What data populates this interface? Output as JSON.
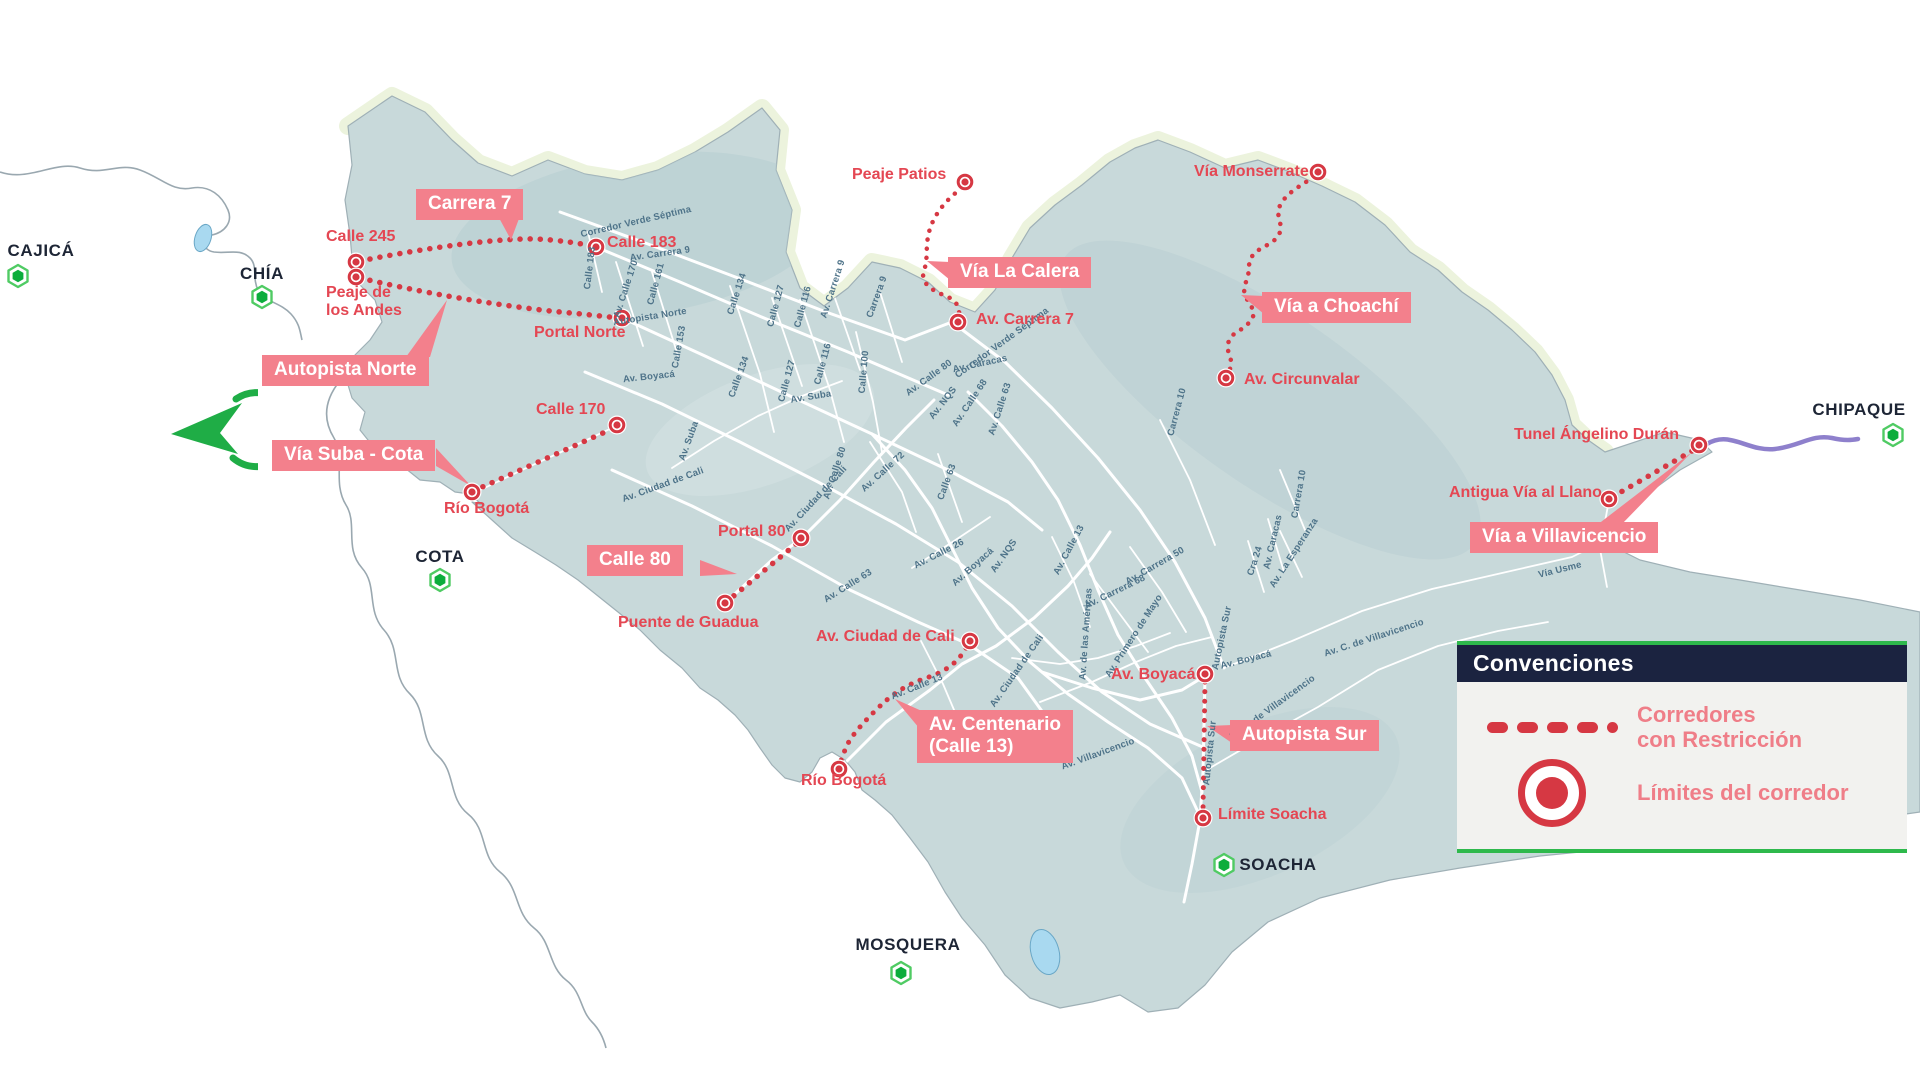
{
  "legend": {
    "title": "Convenciones",
    "items": [
      {
        "icon": "dotted-line-icon",
        "label": "Corredores\ncon Restricción"
      },
      {
        "icon": "red-circle-marker-icon",
        "label": "Límites del corredor"
      }
    ]
  },
  "icons": {
    "municipality_marker": "green-hexagon-icon",
    "corridor_limit_marker": "red-circle-marker-icon",
    "logo": "green-arrow-compass-icon"
  },
  "colors": {
    "map_fill": "#c8d9da",
    "map_hills": "#b7cdd1",
    "mountain_fringe": "#ecf3dd",
    "road": "#ffffff",
    "road_label": "#4e7389",
    "corridor_red": "#d63843",
    "label_red": "#e44753",
    "badge_pink": "#f3808c",
    "navy": "#1b2340",
    "legend_green": "#2eb94c",
    "hexagon_green": "#0cad3c",
    "purple": "#8e80cc",
    "lake_blue": "#a9d9f0",
    "city_text": "#1d2535"
  },
  "badges": [
    {
      "id": "carrera-7",
      "text": "Carrera 7",
      "x": 416,
      "y": 189
    },
    {
      "id": "autopista-norte",
      "text": "Autopista Norte",
      "x": 262,
      "y": 355
    },
    {
      "id": "via-la-calera",
      "text": "Vía La Calera",
      "x": 948,
      "y": 257
    },
    {
      "id": "via-a-choachi",
      "text": "Vía a Choachí",
      "x": 1262,
      "y": 292
    },
    {
      "id": "via-suba-cota",
      "text": "Vía Suba - Cota",
      "x": 272,
      "y": 440
    },
    {
      "id": "calle-80",
      "text": "Calle 80",
      "x": 587,
      "y": 545
    },
    {
      "id": "av-centenario-calle-13",
      "text": "Av. Centenario\n(Calle 13)",
      "x": 917,
      "y": 710
    },
    {
      "id": "autopista-sur",
      "text": "Autopista Sur",
      "x": 1230,
      "y": 720
    },
    {
      "id": "via-a-villavicencio",
      "text": "Vía a Villavicencio",
      "x": 1470,
      "y": 522
    }
  ],
  "points": [
    {
      "id": "calle-245",
      "text": "Calle 245",
      "tx": 326,
      "ty": 228,
      "mx": 356,
      "my": 262
    },
    {
      "id": "peaje-de-los-andes",
      "text": "Peaje de\nlos Andes",
      "tx": 326,
      "ty": 284,
      "mx": 356,
      "my": 277
    },
    {
      "id": "calle-183",
      "text": "Calle 183",
      "tx": 607,
      "ty": 234,
      "mx": 596,
      "my": 247
    },
    {
      "id": "portal-norte",
      "text": "Portal Norte",
      "tx": 534,
      "ty": 324,
      "mx": 622,
      "my": 318
    },
    {
      "id": "peaje-patios",
      "text": "Peaje Patios",
      "tx": 852,
      "ty": 166,
      "mx": 965,
      "my": 182
    },
    {
      "id": "av-carrera-7",
      "text": "Av. Carrera 7",
      "tx": 976,
      "ty": 311,
      "mx": 958,
      "my": 322
    },
    {
      "id": "via-monserrate",
      "text": "Vía Monserrate",
      "tx": 1194,
      "ty": 163,
      "mx": 1318,
      "my": 172
    },
    {
      "id": "av-circunvalar",
      "text": "Av. Circunvalar",
      "tx": 1244,
      "ty": 371,
      "mx": 1226,
      "my": 378
    },
    {
      "id": "calle-170",
      "text": "Calle 170",
      "tx": 536,
      "ty": 401,
      "mx": 617,
      "my": 425
    },
    {
      "id": "rio-bogota-norte",
      "text": "Río Bogotá",
      "tx": 444,
      "ty": 500,
      "mx": 472,
      "my": 492
    },
    {
      "id": "portal-80",
      "text": "Portal 80",
      "tx": 718,
      "ty": 523,
      "mx": 801,
      "my": 538
    },
    {
      "id": "puente-de-guadua",
      "text": "Puente de Guadua",
      "tx": 618,
      "ty": 614,
      "mx": 725,
      "my": 603
    },
    {
      "id": "av-ciudad-de-cali",
      "text": "Av. Ciudad de Cali",
      "tx": 816,
      "ty": 628,
      "mx": 970,
      "my": 641
    },
    {
      "id": "av-boyaca",
      "text": "Av. Boyacá",
      "tx": 1111,
      "ty": 666,
      "mx": 1205,
      "my": 674
    },
    {
      "id": "rio-bogota-sur",
      "text": "Río Bogotá",
      "tx": 801,
      "ty": 772,
      "mx": 839,
      "my": 769
    },
    {
      "id": "limite-soacha",
      "text": "Límite Soacha",
      "tx": 1218,
      "ty": 806,
      "mx": 1203,
      "my": 818
    },
    {
      "id": "tunel-angelino-duran",
      "text": "Tunel Ángelino Durán",
      "tx": 1514,
      "ty": 426,
      "mx": 1699,
      "my": 445
    },
    {
      "id": "antigua-via-al-llano",
      "text": "Antigua Vía al Llano",
      "tx": 1449,
      "ty": 484,
      "mx": 1609,
      "my": 499
    }
  ],
  "cities": [
    {
      "id": "cajica",
      "text": "CAJICÁ",
      "x": 41,
      "y": 251,
      "hx": 18,
      "hy": 276
    },
    {
      "id": "chia",
      "text": "CHÍA",
      "x": 262,
      "y": 274,
      "hx": 262,
      "hy": 297
    },
    {
      "id": "cota",
      "text": "COTA",
      "x": 440,
      "y": 557,
      "hx": 440,
      "hy": 580
    },
    {
      "id": "mosquera",
      "text": "MOSQUERA",
      "x": 908,
      "y": 945,
      "hx": 901,
      "hy": 973
    },
    {
      "id": "soacha",
      "text": "SOACHA",
      "x": 1278,
      "y": 865,
      "hx": 1224,
      "hy": 865
    },
    {
      "id": "chipaque",
      "text": "CHIPAQUE",
      "x": 1859,
      "y": 410,
      "hx": 1893,
      "hy": 435
    }
  ],
  "road_labels": [
    {
      "text": "Corredor Verde Séptima",
      "x": 636,
      "y": 222,
      "rot": -13
    },
    {
      "text": "Av. Carrera 9",
      "x": 660,
      "y": 254,
      "rot": -8
    },
    {
      "text": "Calle 183",
      "x": 590,
      "y": 268,
      "rot": -83
    },
    {
      "text": "Av. Calle 170",
      "x": 626,
      "y": 289,
      "rot": -72
    },
    {
      "text": "Calle 161",
      "x": 656,
      "y": 284,
      "rot": -75
    },
    {
      "text": "Calle 134",
      "x": 737,
      "y": 294,
      "rot": -72
    },
    {
      "text": "Calle 127",
      "x": 776,
      "y": 306,
      "rot": -75
    },
    {
      "text": "Calle 116",
      "x": 803,
      "y": 307,
      "rot": -75
    },
    {
      "text": "Av. Carrera 9",
      "x": 833,
      "y": 289,
      "rot": -72
    },
    {
      "text": "Carrera 9",
      "x": 877,
      "y": 297,
      "rot": -70
    },
    {
      "text": "Calle 100",
      "x": 864,
      "y": 372,
      "rot": -85
    },
    {
      "text": "Autopista Norte",
      "x": 650,
      "y": 317,
      "rot": -9
    },
    {
      "text": "Calle 153",
      "x": 679,
      "y": 347,
      "rot": -80
    },
    {
      "text": "Calle 134",
      "x": 739,
      "y": 377,
      "rot": -70
    },
    {
      "text": "Calle 127",
      "x": 787,
      "y": 381,
      "rot": -75
    },
    {
      "text": "Calle 116",
      "x": 823,
      "y": 364,
      "rot": -75
    },
    {
      "text": "Av. Boyacá",
      "x": 649,
      "y": 377,
      "rot": -6
    },
    {
      "text": "Av. Suba",
      "x": 811,
      "y": 397,
      "rot": -9
    },
    {
      "text": "Av. Suba",
      "x": 689,
      "y": 441,
      "rot": -70
    },
    {
      "text": "Av. Calle 80",
      "x": 929,
      "y": 378,
      "rot": -36
    },
    {
      "text": "Av. Caracas",
      "x": 980,
      "y": 364,
      "rot": -12
    },
    {
      "text": "Av. NQS",
      "x": 943,
      "y": 403,
      "rot": -52
    },
    {
      "text": "Av. Calle 68",
      "x": 970,
      "y": 403,
      "rot": -56
    },
    {
      "text": "Av. Calle 63",
      "x": 1000,
      "y": 409,
      "rot": -72
    },
    {
      "text": "Corredor Verde Séptima",
      "x": 1002,
      "y": 343,
      "rot": -36
    },
    {
      "text": "Av. Calle 72",
      "x": 883,
      "y": 472,
      "rot": -42
    },
    {
      "text": "Calle 63",
      "x": 947,
      "y": 482,
      "rot": -70
    },
    {
      "text": "Av. Ciudad de Cali",
      "x": 663,
      "y": 485,
      "rot": -20
    },
    {
      "text": "Av. Calle 80",
      "x": 835,
      "y": 473,
      "rot": -72
    },
    {
      "text": "Av. Ciudad de Cali",
      "x": 816,
      "y": 499,
      "rot": -47
    },
    {
      "text": "Av. Calle 63",
      "x": 848,
      "y": 586,
      "rot": -32
    },
    {
      "text": "Av. NQS",
      "x": 1004,
      "y": 556,
      "rot": -55
    },
    {
      "text": "Av. Calle 26",
      "x": 939,
      "y": 554,
      "rot": -27
    },
    {
      "text": "Av. Boyacá",
      "x": 973,
      "y": 567,
      "rot": -42
    },
    {
      "text": "Av. Calle 13",
      "x": 1069,
      "y": 550,
      "rot": -62
    },
    {
      "text": "Av. Carrera 50",
      "x": 1155,
      "y": 566,
      "rot": -30
    },
    {
      "text": "Av. Carrera 68",
      "x": 1115,
      "y": 592,
      "rot": -26
    },
    {
      "text": "Av. La Esperanza",
      "x": 1294,
      "y": 553,
      "rot": -57
    },
    {
      "text": "Av. de las Américas",
      "x": 1086,
      "y": 634,
      "rot": -86
    },
    {
      "text": "Av. Primero de Mayo",
      "x": 1134,
      "y": 636,
      "rot": -57
    },
    {
      "text": "Autopista Sur",
      "x": 1222,
      "y": 638,
      "rot": -78
    },
    {
      "text": "Av. Boyacá",
      "x": 1246,
      "y": 660,
      "rot": -14
    },
    {
      "text": "Cra 24",
      "x": 1255,
      "y": 561,
      "rot": -72
    },
    {
      "text": "Av. Caracas",
      "x": 1273,
      "y": 542,
      "rot": -77
    },
    {
      "text": "Av. Calle 13",
      "x": 917,
      "y": 687,
      "rot": -22
    },
    {
      "text": "Av. Ciudad de Cali",
      "x": 1017,
      "y": 671,
      "rot": -55
    },
    {
      "text": "Av. C. de Villavicencio",
      "x": 1374,
      "y": 638,
      "rot": -18
    },
    {
      "text": "Av. C. de Villavicencio",
      "x": 1272,
      "y": 708,
      "rot": -36
    },
    {
      "text": "Autopista Sur",
      "x": 1210,
      "y": 753,
      "rot": -84
    },
    {
      "text": "Av. Villavicencio",
      "x": 1098,
      "y": 754,
      "rot": -20
    },
    {
      "text": "Vía Usme",
      "x": 1560,
      "y": 570,
      "rot": -14
    },
    {
      "text": "Carrera 10",
      "x": 1177,
      "y": 412,
      "rot": -75
    },
    {
      "text": "Carrera 10",
      "x": 1299,
      "y": 494,
      "rot": -80
    }
  ]
}
